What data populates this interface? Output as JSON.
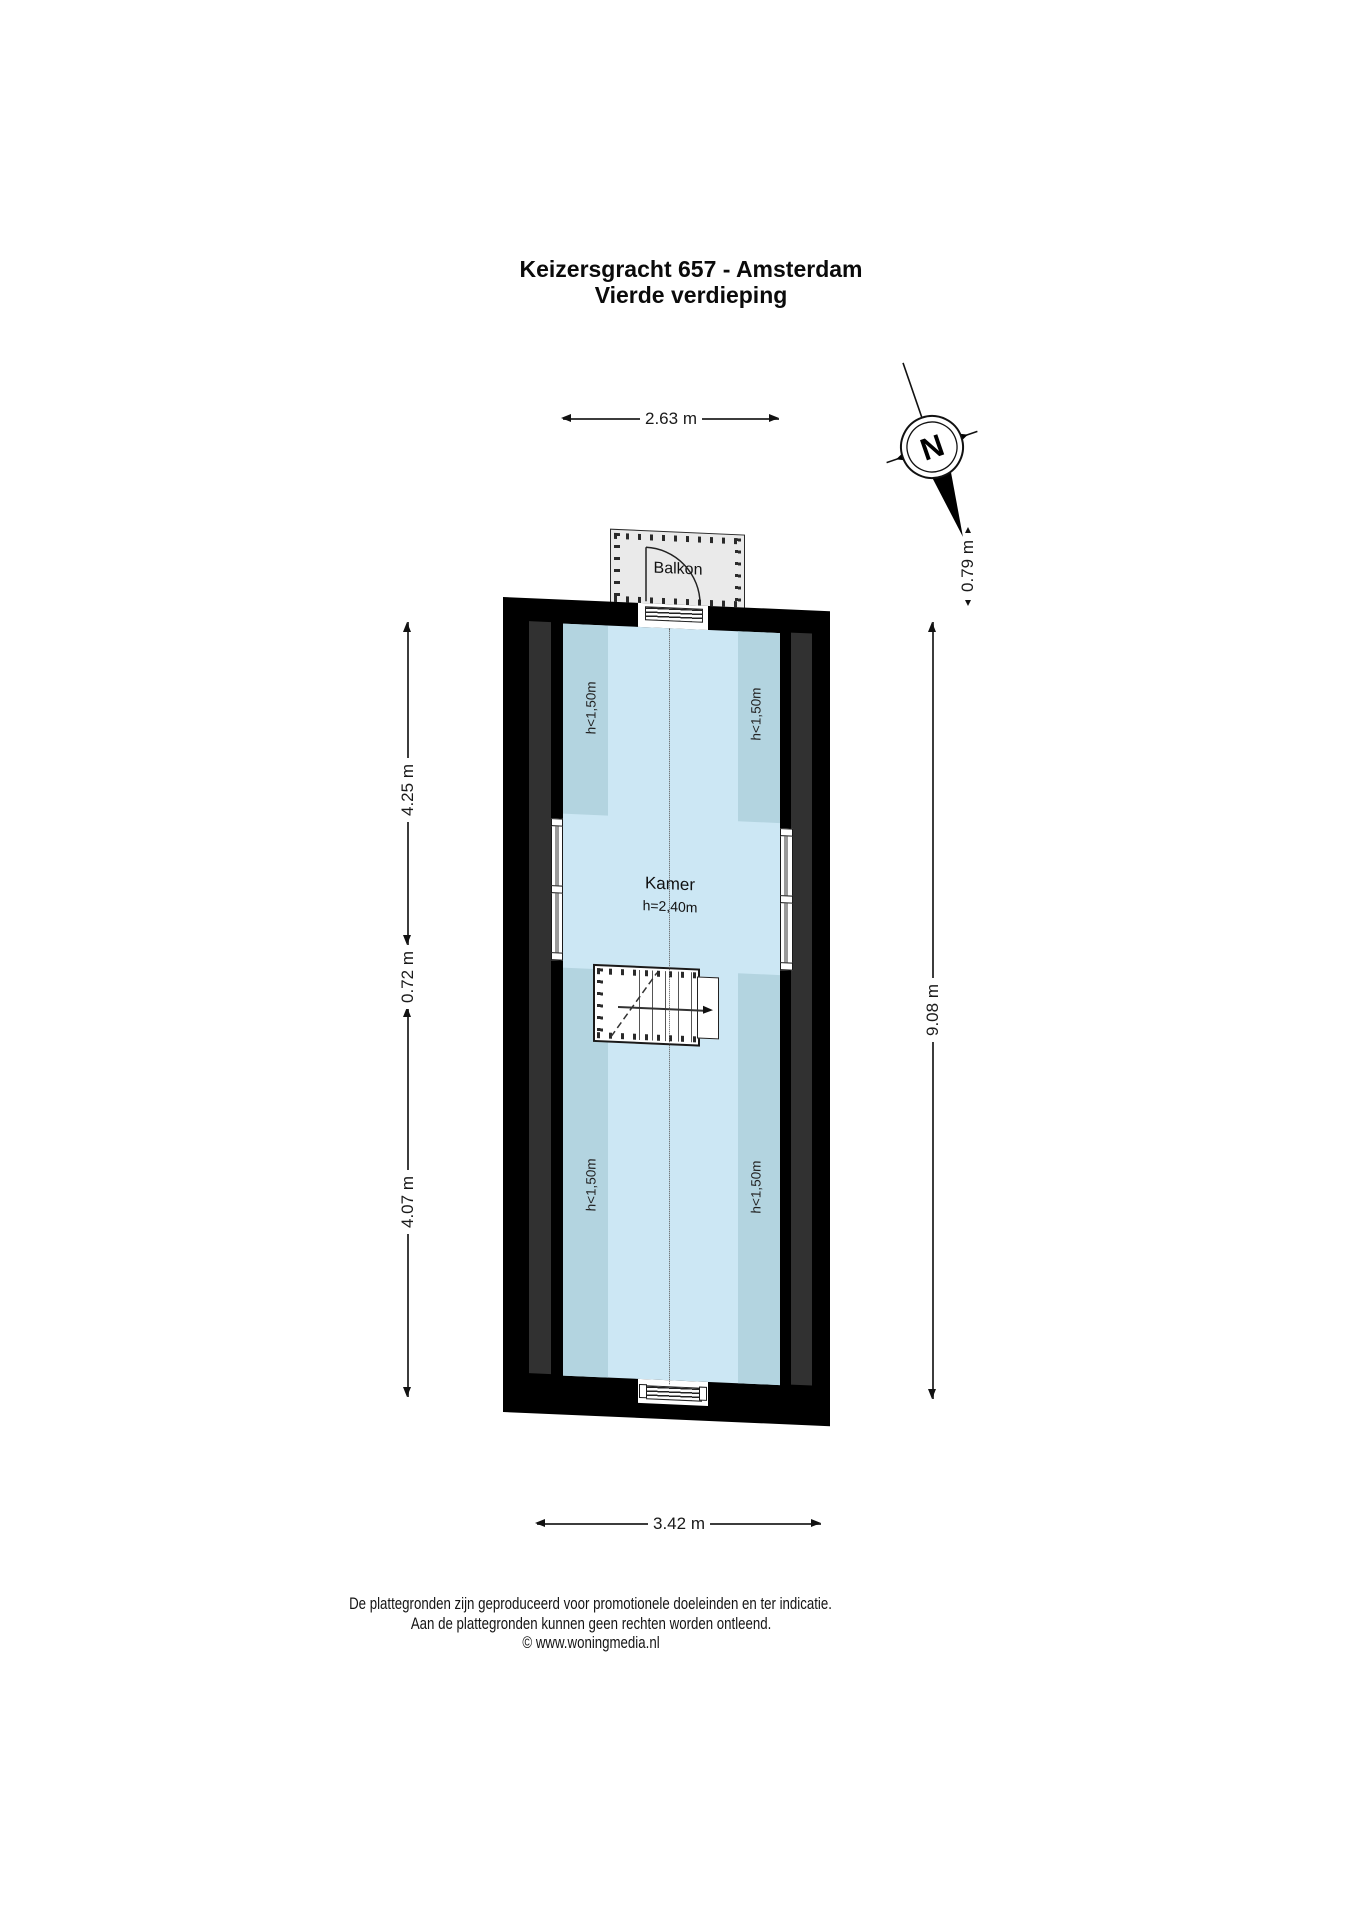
{
  "title": {
    "line1": "Keizersgracht 657 - Amsterdam",
    "line2": "Vierde verdieping"
  },
  "compass": {
    "north_label": "N"
  },
  "dimensions": {
    "top_width": "2.63 m",
    "balcony_depth": "0.79 m",
    "left_upper": "4.25 m",
    "left_middle": "0.72 m",
    "left_lower": "4.07 m",
    "right_total": "9.08 m",
    "bottom_width": "3.42 m"
  },
  "labels": {
    "balcony": "Balkon",
    "room_name": "Kamer",
    "room_height": "h=2,40m",
    "low_zone_top_left": "h<1,50m",
    "low_zone_top_right": "h<1,50m",
    "low_zone_bottom_left": "h<1,50m",
    "low_zone_bottom_right": "h<1,50m"
  },
  "footer": {
    "line1": "De plattegronden zijn geproduceerd voor promotionele doeleinden en ter indicatie.",
    "line2": "Aan de plattegronden kunnen geen rechten worden ontleend.",
    "line3": "© www.woningmedia.nl"
  },
  "colors": {
    "floor": "#cce7f4",
    "low_zone": "#b3d4e0",
    "wall": "#000000",
    "wall_inner_strip": "#313131",
    "balcony_fill": "#eaeaea"
  }
}
